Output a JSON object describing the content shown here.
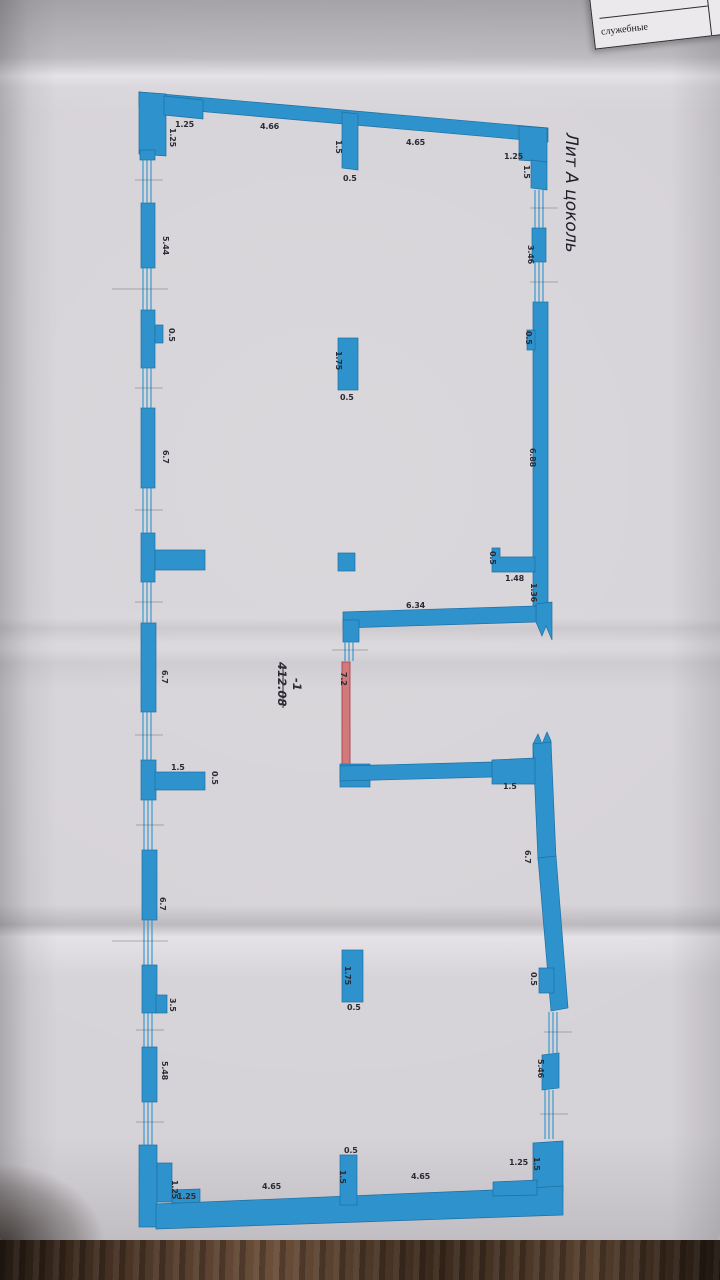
{
  "document": {
    "title": "Лит А цоколь",
    "room": {
      "number": "-1",
      "area": "412.08"
    },
    "corner_table": {
      "row1": "культурно-бытовые",
      "row2": "служебные"
    },
    "colors": {
      "wall_fill": "#2e93cc",
      "wall_stroke": "#1d6fa3",
      "red_wall_fill": "#d2797c",
      "red_wall_stroke": "#a8444a"
    }
  },
  "dims": {
    "top": [
      "1.25",
      "4.66",
      "1.5",
      "0.5",
      "4.65",
      "1.25",
      "1.5"
    ],
    "left": [
      "1.25",
      "5.44",
      "0.5",
      "6.7",
      "6.7",
      "1.5",
      "0.5",
      "6.7",
      "3.5",
      "5.48",
      "1.25",
      "1.25"
    ],
    "right": [
      "3.46",
      "0.5",
      "6.88",
      "0.5",
      "1.48",
      "1.36",
      "1.5",
      "6.7",
      "0.5",
      "5.46",
      "1.25",
      "1.5"
    ],
    "bottom": [
      "4.65",
      "1.5",
      "0.5",
      "4.65"
    ],
    "center": [
      "1.75",
      "0.5",
      "6.34",
      "7.2",
      "1.75",
      "0.5"
    ]
  }
}
